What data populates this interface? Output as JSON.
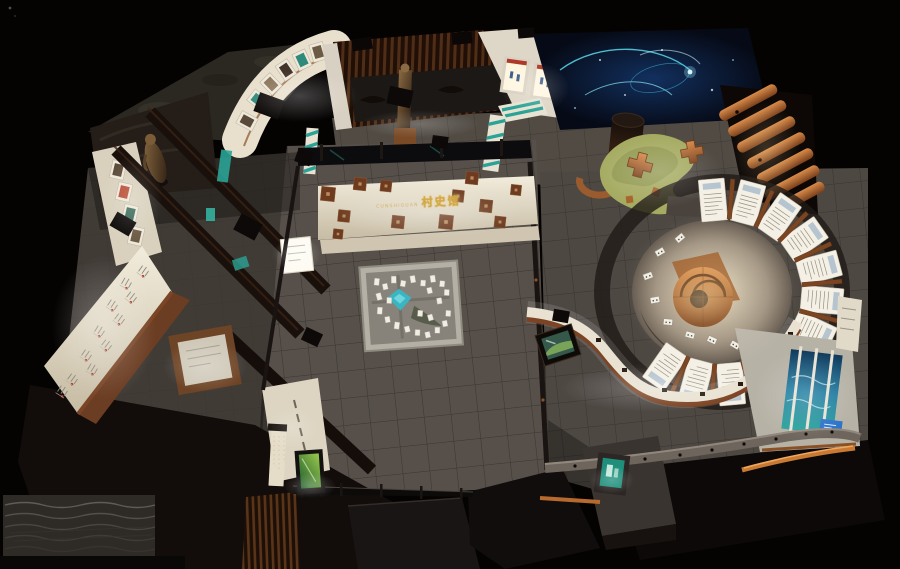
{
  "meta": {
    "description": "Night-time bird's-eye 3D rendering of a village history museum exhibition hall",
    "canvas_width": 900,
    "canvas_height": 569,
    "background": "#050302"
  },
  "sign": {
    "prefix": "CUNSHIGUAN",
    "text": "村史馆",
    "color": "#d2a944"
  },
  "palette": {
    "floor_tile": "#57504a",
    "ivory_wall": "#e9e1cf",
    "copper": "#8a5126",
    "wood_bright": "#d98c4a",
    "slat_wood": "#6b3c1e",
    "teal_accent": "#2aa396",
    "pond_teal": "#3ab5c2",
    "galaxy_navy": "#0a1a38",
    "galaxy_cyan": "#6ee0f2",
    "moss_green": "#a6ab62",
    "sea_blue": "#1d7aa0",
    "screen_green": "#55a23c",
    "gold": "#d2a944",
    "dark_wall": "#141010"
  },
  "elements": {
    "central_model": "village scale-model sand table with teal pond",
    "spiral_gallery": "circular exhibit of white info panels around wooden spiral ramp",
    "curved_counter": "S-curved white display counter",
    "galaxy_ceiling": "dark starry projection mural",
    "green_lounge": "S-shaped green mat with wooden cross stools",
    "wood_slat_room": "timber slat room with bronze statue",
    "photo_gallery": "curved arched photo wall",
    "artifact_counter": "long white artifact display counter",
    "sea_mural_room": "blue water mural exhibit room",
    "media_kiosk": "green glowing media screen",
    "exit_sign": "teal glowing wall sign",
    "wave_wall": "rippled relief wall",
    "wood_steps": "cascading timber wave steps"
  }
}
